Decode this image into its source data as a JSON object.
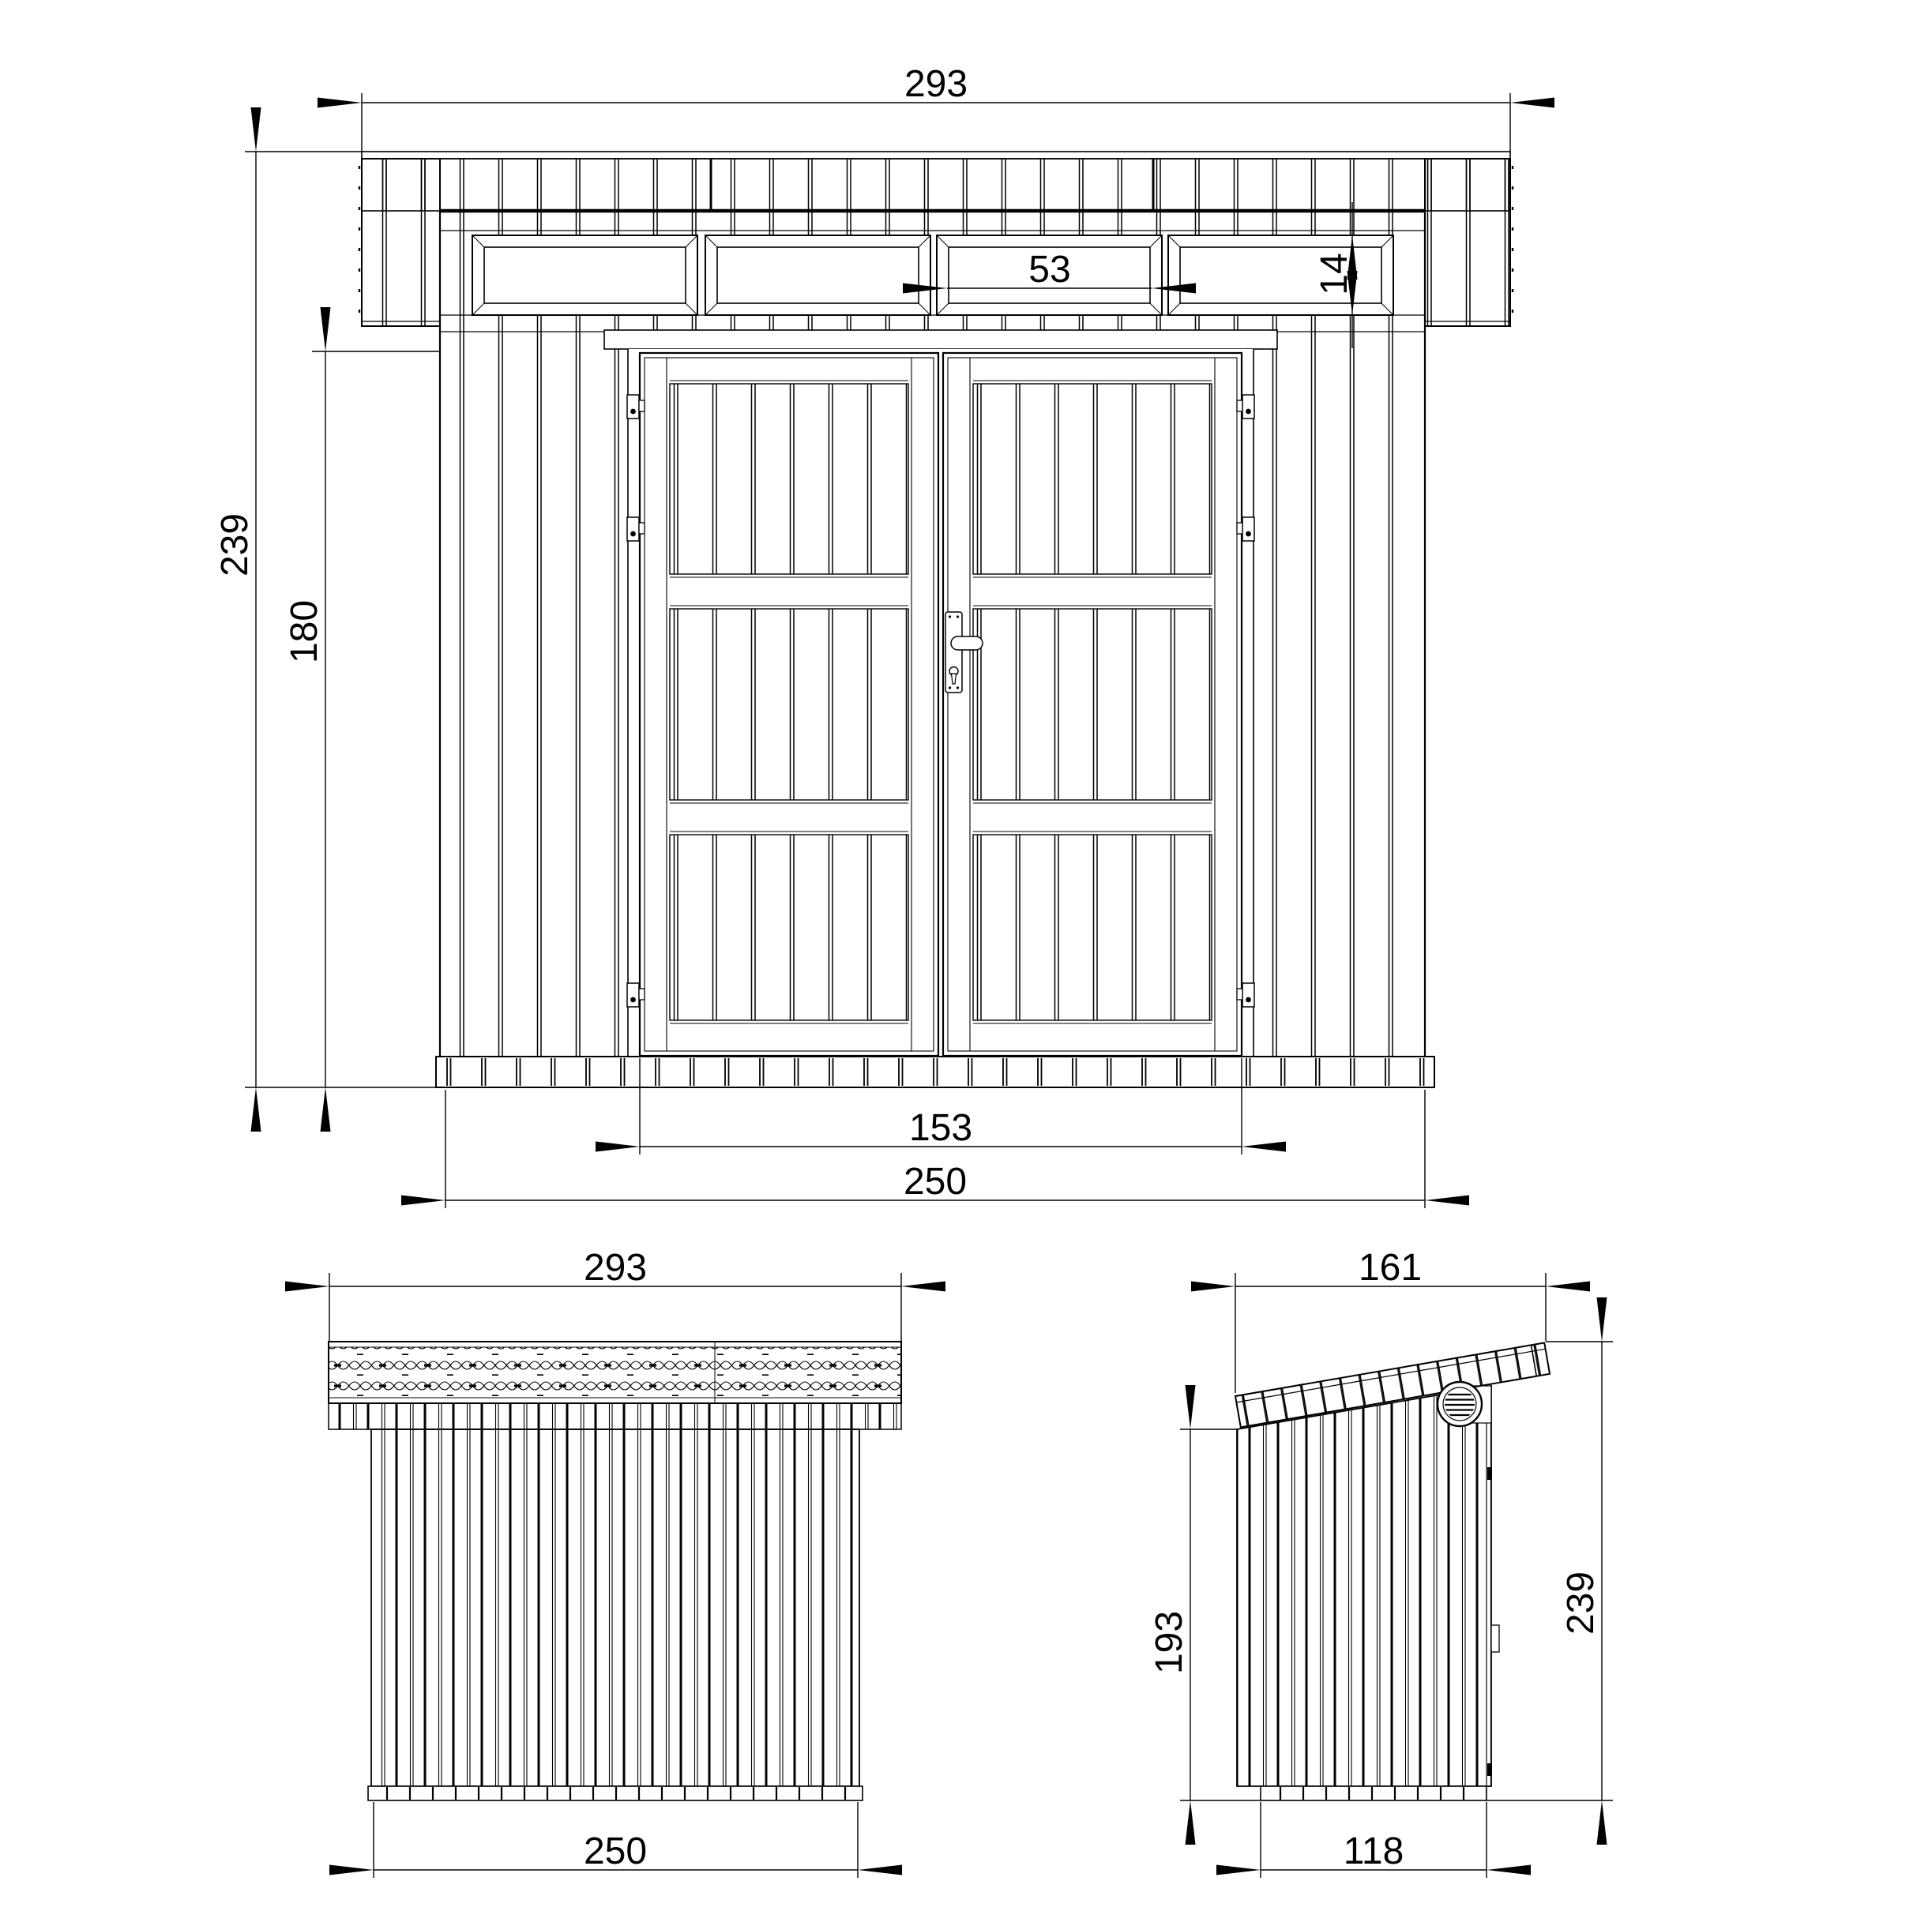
{
  "drawing": {
    "type": "technical-3-view-shed-drawing",
    "colors": {
      "line": "#000000",
      "background": "#ffffff"
    },
    "views": {
      "front": {
        "dims": {
          "roof_width": "293",
          "total_height": "239",
          "wall_height": "180",
          "transom_window_height": "14",
          "transom_window_width": "53",
          "door_width": "153",
          "body_width": "250"
        }
      },
      "rear": {
        "dims": {
          "roof_width": "293",
          "body_width": "250"
        }
      },
      "side": {
        "dims": {
          "roof_depth": "161",
          "rear_wall_height": "193",
          "front_height": "239",
          "base_depth": "118"
        }
      }
    }
  }
}
